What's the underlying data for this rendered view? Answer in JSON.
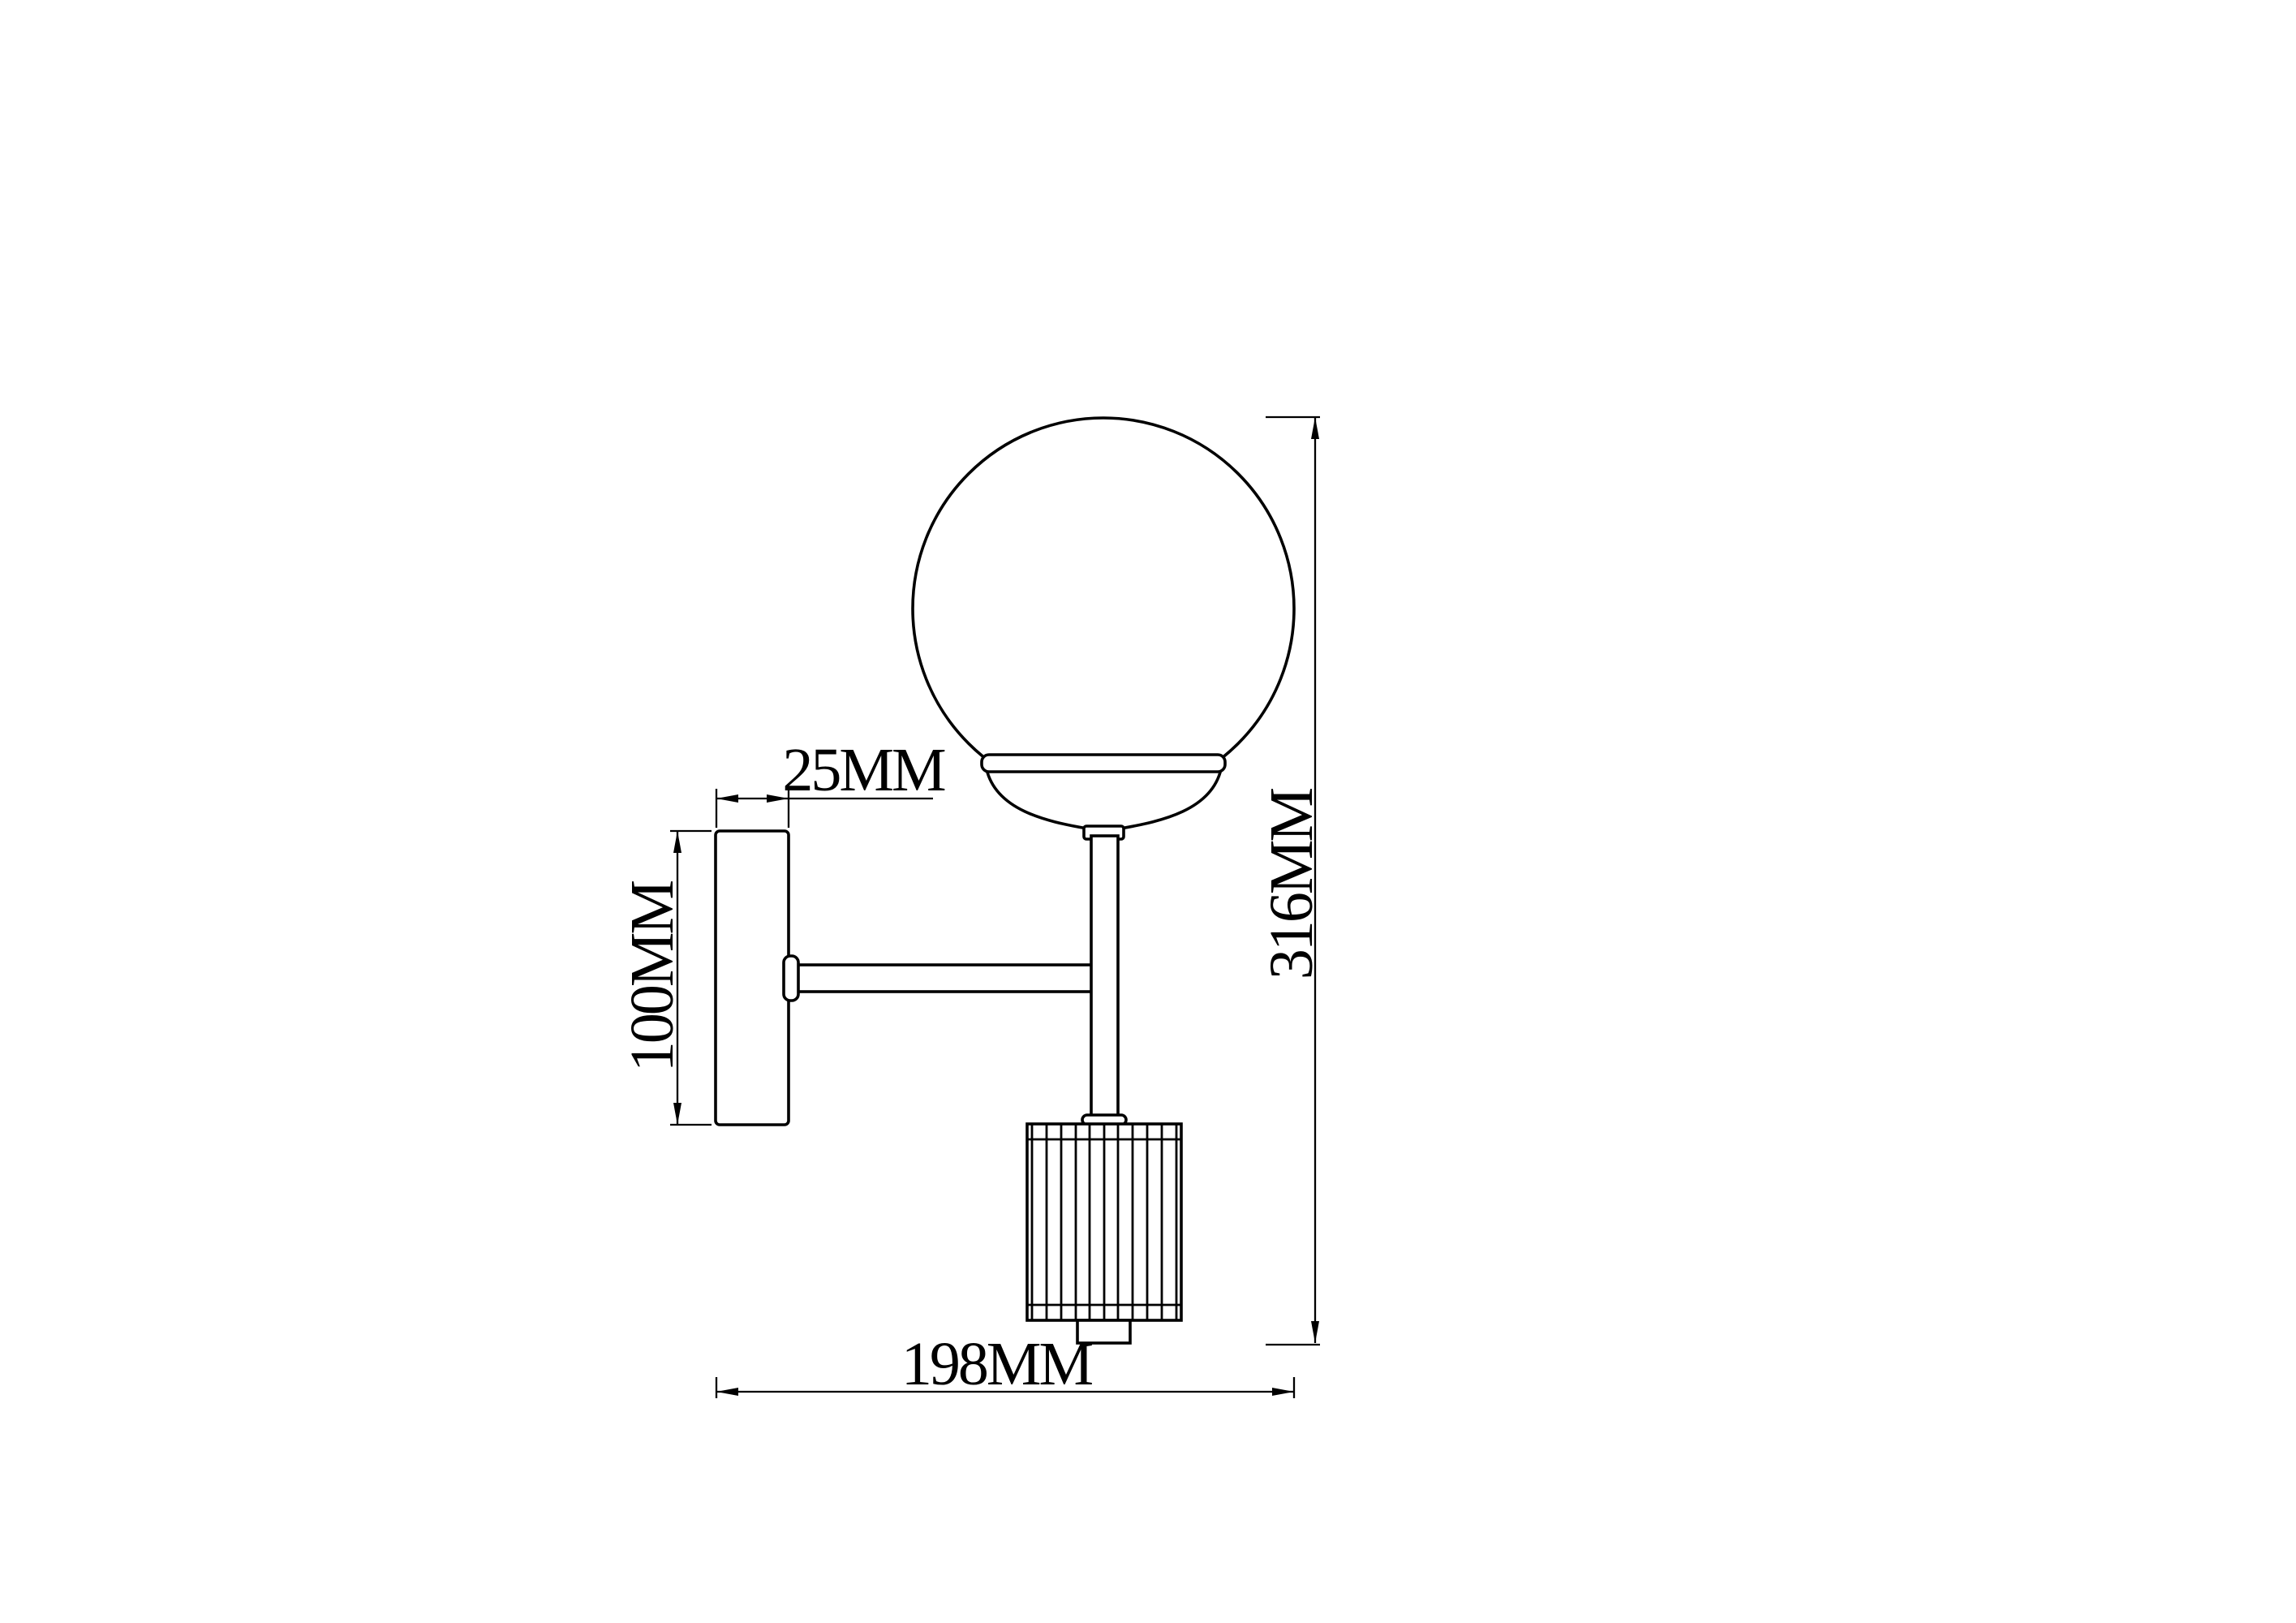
{
  "dimensions": {
    "plate_width": {
      "label": "25MM",
      "value_mm": 25
    },
    "plate_height": {
      "label": "100MM",
      "value_mm": 100
    },
    "total_height": {
      "label": "316MM",
      "value_mm": 316
    },
    "total_depth": {
      "label": "198MM",
      "value_mm": 198
    }
  },
  "colors": {
    "line": "#000000",
    "background": "#ffffff"
  }
}
